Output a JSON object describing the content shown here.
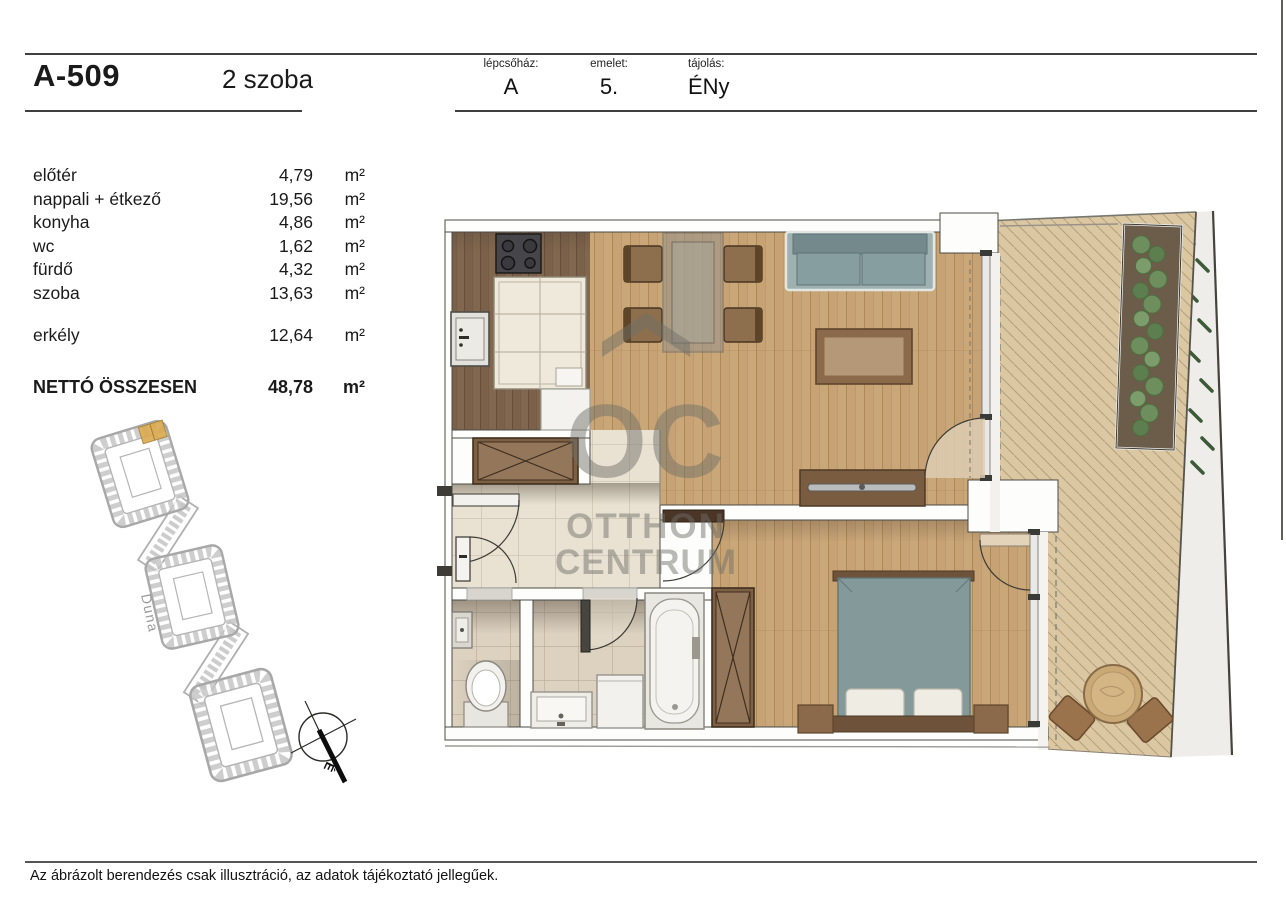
{
  "header": {
    "unit_id": "A-509",
    "unit_type": "2 szoba",
    "fields": [
      {
        "label": "lépcsőház:",
        "value": "A"
      },
      {
        "label": "emelet:",
        "value": "5."
      },
      {
        "label": "tájolás:",
        "value": "ÉNy"
      }
    ]
  },
  "rooms": [
    {
      "name": "előtér",
      "area": "4,79",
      "unit": "m²"
    },
    {
      "name": "nappali + étkező",
      "area": "19,56",
      "unit": "m²"
    },
    {
      "name": "konyha",
      "area": "4,86",
      "unit": "m²"
    },
    {
      "name": "wc",
      "area": "1,62",
      "unit": "m²"
    },
    {
      "name": "fürdő",
      "area": "4,32",
      "unit": "m²"
    },
    {
      "name": "szoba",
      "area": "13,63",
      "unit": "m²"
    }
  ],
  "balcony_row": {
    "name": "erkély",
    "area": "12,64",
    "unit": "m²"
  },
  "total_row": {
    "name": "NETTÓ ÖSSZESEN",
    "area": "48,78",
    "unit": "m²"
  },
  "site_plan": {
    "river_label": "Duna",
    "compass_letter": "É",
    "highlight_color": "#d9a94f"
  },
  "watermark": {
    "line1": "OC",
    "line2": "OTTHON",
    "line3": "CENTRUM"
  },
  "footer": {
    "disclaimer": "Az ábrázolt berendezés csak illusztráció, az adatok tájékoztató jellegűek."
  },
  "colors": {
    "wood_light": "#c6a274",
    "wood_dark": "#7c614a",
    "deck": "#dbc8a3",
    "tile": "#e9e2d2",
    "sofa_teal": "#879ea0",
    "plant_green": "#6e8f5d"
  }
}
